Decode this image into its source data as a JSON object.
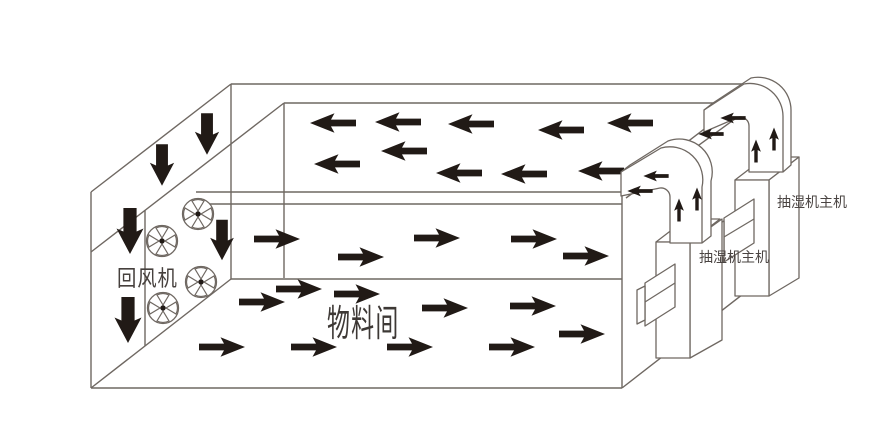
{
  "diagram": {
    "title_visible": false,
    "labels": {
      "material_room": "物料间",
      "return_fan": "回风机",
      "dehumidifier_front": "抽湿机主机",
      "dehumidifier_back": "抽湿机主机"
    },
    "icons": {
      "fan": "fan-icon",
      "arrow_left": "left-arrow",
      "arrow_right": "right-arrow",
      "arrow_down": "down-arrow",
      "arrow_up": "up-arrow"
    },
    "airflow": {
      "ceiling_plenum": {
        "direction": "left",
        "arrow_count": 10
      },
      "upper_room": {
        "direction": "right",
        "arrow_count": 5
      },
      "floor_room": {
        "direction": "right",
        "arrow_count": 10
      },
      "return_wall": {
        "direction": "down",
        "arrow_count": 5
      },
      "duct_front": {
        "direction": "up-then-left",
        "arrow_count": 4
      },
      "duct_back": {
        "direction": "up-then-left",
        "arrow_count": 4
      }
    },
    "equipment": {
      "return_fans_count": 4,
      "dehumidifier_units_count": 2
    },
    "colors": {
      "background": "#ffffff",
      "line": "#6f6862",
      "arrow": "#211a16",
      "text": "#46403d"
    }
  }
}
